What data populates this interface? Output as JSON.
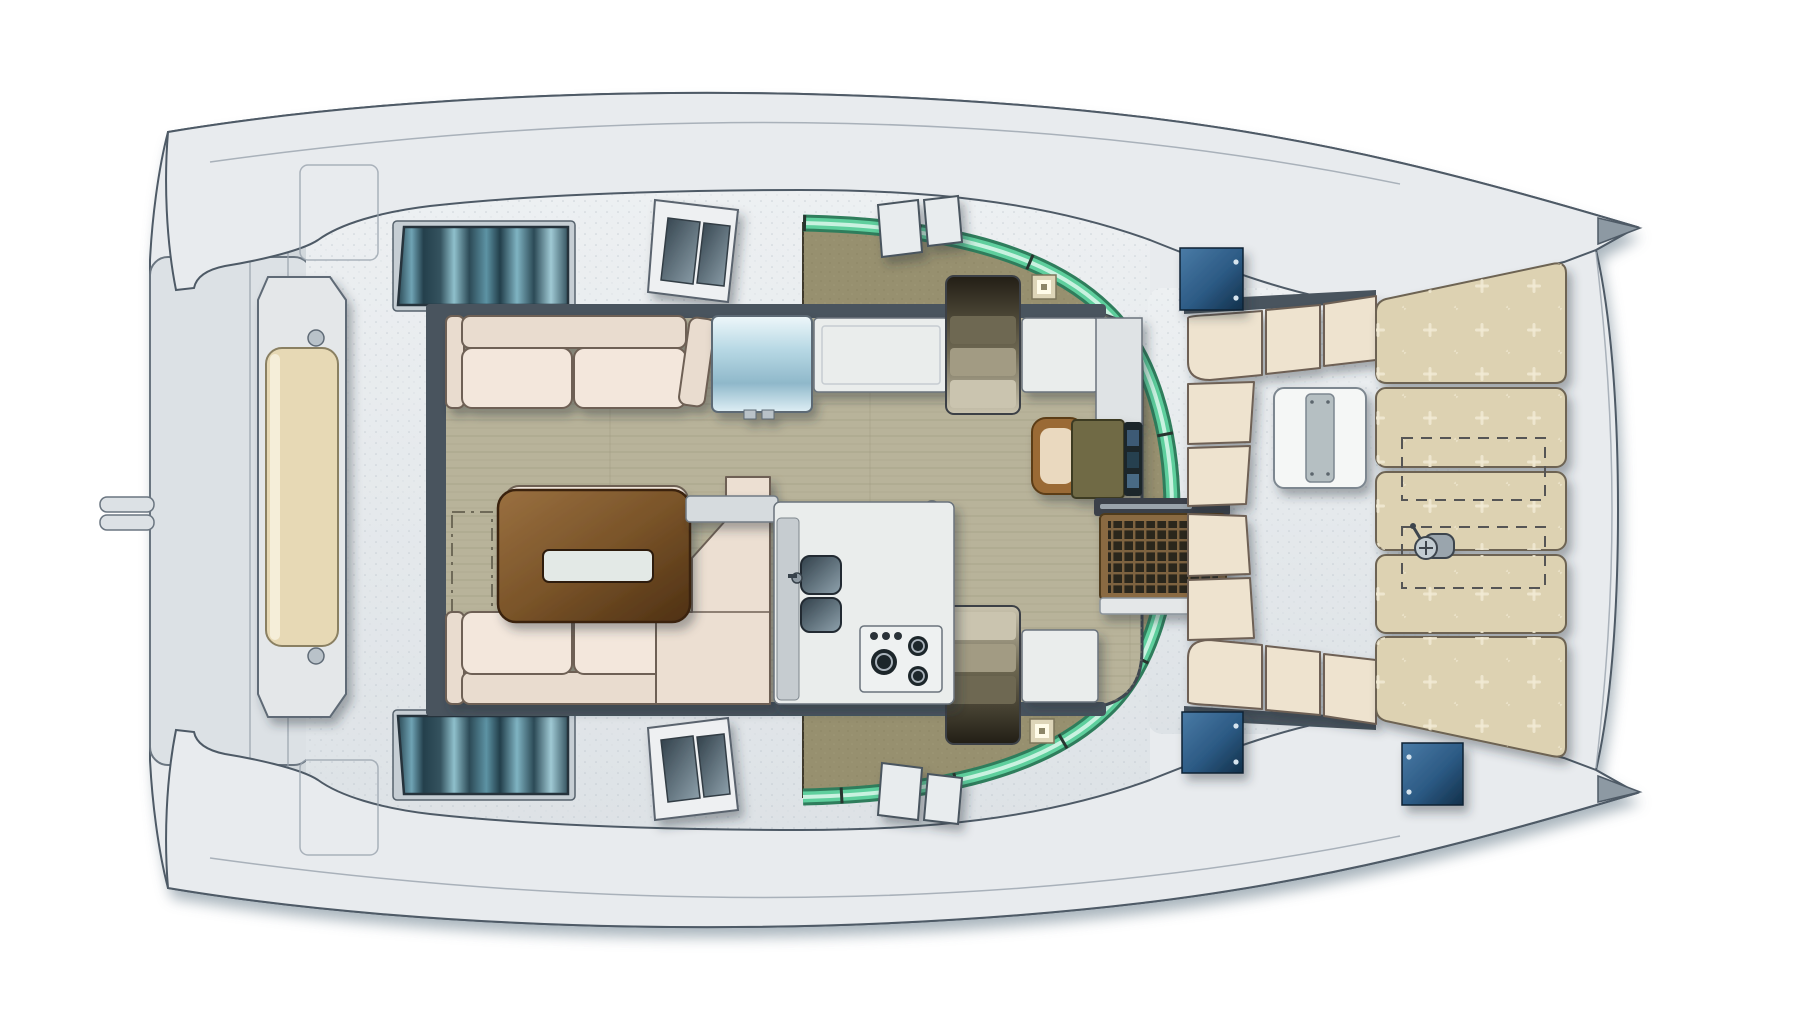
{
  "meta": {
    "title": "Catamaran deck and saloon layout - top view floor plan",
    "type": "boat-deck-plan",
    "view": "top-down",
    "visible_text": "none"
  },
  "colors": {
    "background": "#ffffff",
    "hull": "#e8ebee",
    "hull_stroke": "#4e5a66",
    "hull_shadow": "#9aa7b1",
    "deck": "#e3e7ea",
    "deck_speck": "#b9c2c9",
    "beam": "#d2d8dc",
    "slab": "#dce1e5",
    "bench_gray": "#e4e7e9",
    "bench_cushion": "#e7d9b5",
    "saloon_floor": "#b8b39a",
    "floor_grain": "#a39e84",
    "khaki": "#97906f",
    "khaki_dot": "#857e5e",
    "glass_outer": "#2f7d5c",
    "glass_mid": "#5ecf9d",
    "glass_hi": "#c9f2e0",
    "wall_dark": "#49545e",
    "sofa_cream": "#f3e7dc",
    "sofa_cream2": "#e9dccf",
    "sofa_stroke": "#6e6154",
    "corner_beige": "#ecdfd2",
    "table_w1": "#9a7040",
    "table_w2": "#4e3013",
    "table_inset": "#e3e9e6",
    "counter": "#eaedec",
    "counter_stroke": "#6a737c",
    "marble": "#c6ccd0",
    "sink_dark": "#31404a",
    "sink_light": "#8fa2ad",
    "stove": "#eef1f1",
    "burner": "#1f262b",
    "fridge1": "#eef7fa",
    "fridge2": "#8fb8ca",
    "stairs_light": "#cac4af",
    "stairs_mid": "#a29b83",
    "stairs_deep": "#6e6852",
    "stairs_dark": "#221e15",
    "olive": "#6f6a45",
    "chair_wood": "#9a6a36",
    "chair_pad": "#ead9bf",
    "instr": "#1e252b",
    "cockpit_beige": "#eee3cf",
    "white_table": "#f5f7f6",
    "table_leaf": "#b5bfc2",
    "sunpad": "#ddd2b2",
    "sunpad_dot": "#f1ead4",
    "cushion_stroke": "#6d6452",
    "grate_frame": "#8a6a42",
    "grate_dark": "#2c251c",
    "grate_bar": "#7d6240",
    "lintel": "#3a4148",
    "hatch_b1": "#4a7ba6",
    "hatch_b2": "#12304a",
    "win_d": "#24404c",
    "win_l": "#8fc0cc",
    "light_sq": "#fffce9",
    "lamp": "#b9c2c8",
    "dash_stroke": "#6f6a58"
  },
  "plan": {
    "vessel": "catamaran",
    "areas": [
      {
        "name": "bow-crossbeam-bench",
        "cushions": 1
      },
      {
        "name": "foredeck-walkway",
        "vent_groups": 8
      },
      {
        "name": "saloon-dinette",
        "sofas": 3,
        "table": 1,
        "table_tray": 1,
        "floor": "wood-plank"
      },
      {
        "name": "galley-aft",
        "sinks": 2,
        "burners": 3,
        "knobs": 3,
        "refrigerator": 1,
        "counters": 4
      },
      {
        "name": "navigation-station",
        "desk": 1,
        "chair": 1,
        "instrument_screens": 3
      },
      {
        "name": "companionway-stairs",
        "count": 2
      },
      {
        "name": "cockpit",
        "l_sofas": 2,
        "dining_table": 1,
        "door_grate": 1
      },
      {
        "name": "aft-sunpad-bench",
        "cushions": 5,
        "storage_lockers_dashed": 2,
        "engine-throttle": 1
      }
    ],
    "fixtures": {
      "blue_deck_hatches": 3,
      "roof_light_squares": 2,
      "hull_windows": 2,
      "windshield_panels": 2,
      "coachroof_hatches": 4,
      "glass_band": "wraparound aft glazing, teal-green",
      "ceiling_lamp": 1,
      "bowsprit_fittings": 2
    }
  }
}
